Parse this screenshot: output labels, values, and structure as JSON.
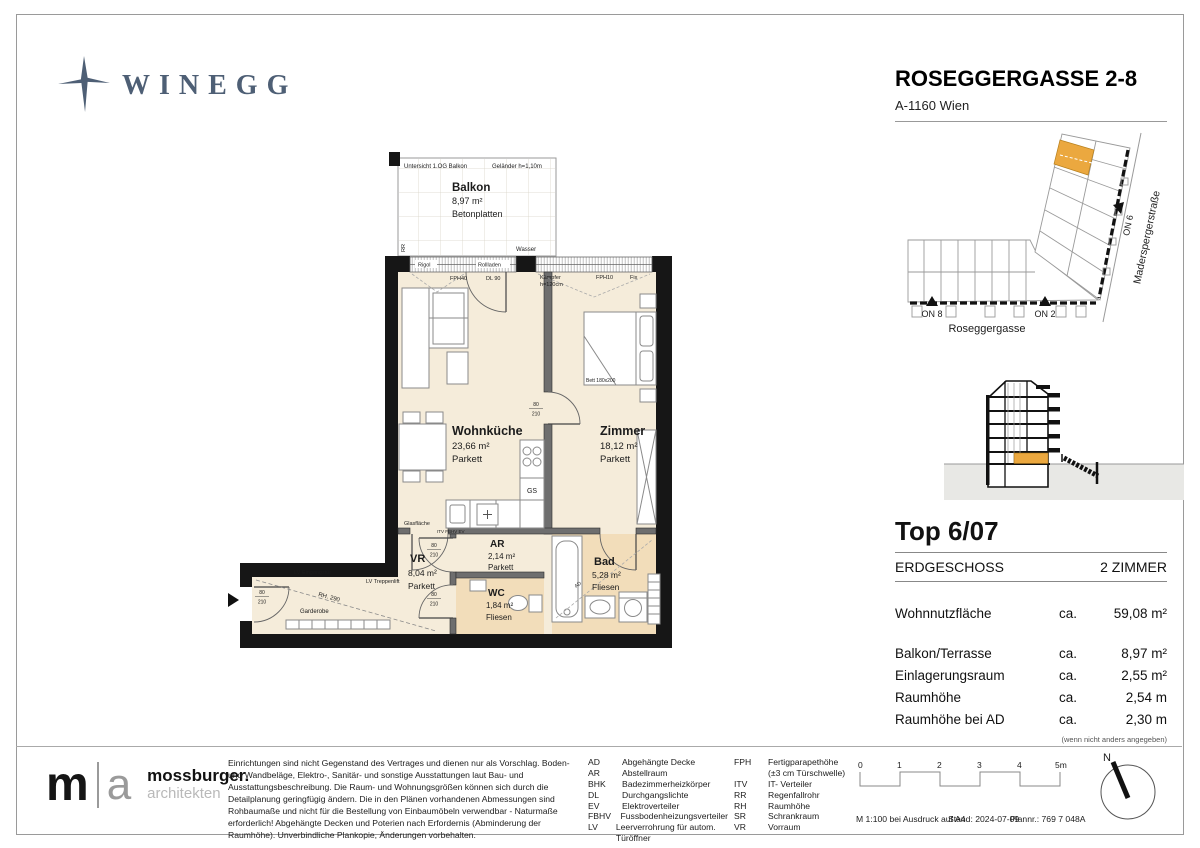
{
  "colors": {
    "brand_blue": "#4E5F75",
    "accent_orange": "#EBA83F",
    "floor_parkett": "#F5ECDA",
    "floor_fliesen": "#F2DDBA",
    "wall_black": "#161616",
    "ground_gray": "#E8E8E5"
  },
  "brand": {
    "logo_text": "WINEGG"
  },
  "header": {
    "title": "ROSEGGERGASSE 2-8",
    "subtitle": "A-1160 Wien"
  },
  "site_plan": {
    "street_bottom": "Roseggergasse",
    "street_right": "Maderspergerstraße",
    "on8": "ON 8",
    "on2": "ON 2",
    "on6": "ON 6"
  },
  "unit": {
    "top": "Top 6/07",
    "floor": "ERDGESCHOSS",
    "rooms": "2 ZIMMER",
    "metrics": [
      {
        "label": "Wohnnutzfläche",
        "ca": "ca.",
        "value": "59,08 m²"
      },
      {
        "label": "Balkon/Terrasse",
        "ca": "ca.",
        "value": "8,97 m²"
      },
      {
        "label": "Einlagerungsraum",
        "ca": "ca.",
        "value": "2,55 m²"
      },
      {
        "label": "Raumhöhe",
        "ca": "ca.",
        "value": "2,54 m"
      },
      {
        "label": "Raumhöhe bei AD",
        "ca": "ca.",
        "value": "2,30 m"
      }
    ],
    "note": "(wenn nicht anders angegeben)"
  },
  "plan": {
    "rooms": {
      "balkon": {
        "name": "Balkon",
        "area": "8,97 m²",
        "floor": "Betonplatten"
      },
      "wohnkueche": {
        "name": "Wohnküche",
        "area": "23,66 m²",
        "floor": "Parkett"
      },
      "zimmer": {
        "name": "Zimmer",
        "area": "18,12 m²",
        "floor": "Parkett"
      },
      "ar": {
        "name": "AR",
        "area": "2,14 m²",
        "floor": "Parkett"
      },
      "vr": {
        "name": "VR",
        "area": "8,04 m²",
        "floor": "Parkett"
      },
      "wc": {
        "name": "WC",
        "area": "1,84 m²",
        "floor": "Fliesen"
      },
      "bad": {
        "name": "Bad",
        "area": "5,28 m²",
        "floor": "Fliesen"
      }
    },
    "annotations": {
      "untersicht": "Untersicht 1.OG Balkon",
      "gelaender": "Geländer h=1,10m",
      "rigol": "Rigol",
      "rollladen": "Rollladen",
      "fph40": "FPH40",
      "dl90": "DL 90",
      "kaempfer": "Kämpfer",
      "kaempfer2": "h=120cm",
      "fph10": "FPH10",
      "fix": "Fix",
      "wasser": "Wasser",
      "rr": "RR",
      "gs": "GS",
      "ev_row": "ITV  FBHV  EV",
      "glas": "Glasfläche",
      "bett": "Bett 180x200",
      "lv_eingang": "LV Eingangstür",
      "lv_treppe": "LV Treppenlift",
      "garderobe": "Garderobe",
      "rh290": "RH. 290",
      "ad": "AD",
      "marker": "6/07",
      "dim_top": "80",
      "dim_bottom": "210"
    }
  },
  "footer": {
    "architect": {
      "mark_m": "m",
      "mark_a": "a",
      "name": "mossburger.",
      "subtitle": "architekten"
    },
    "disclaimer": "Einrichtungen sind nicht Gegenstand des Vertrages und dienen nur als Vorschlag. Boden- und Wandbeläge, Elektro-, Sanitär- und sonstige Ausstattungen laut Bau- und Ausstattungsbeschreibung. Die Raum- und Wohnungsgrößen können sich durch die Detailplanung geringfügig ändern. Die in den Plänen vorhandenen Abmessungen sind Rohbaumaße und nicht für die Bestellung von Einbaumöbeln verwendbar - Naturmaße erforderlich! Abgehängte Decken und Poterien nach Erfordernis (Abminderung der Raumhöhe). Unverbindliche Plankopie, Änderungen vorbehalten.",
    "legend_left": [
      {
        "abbr": "AD",
        "term": "Abgehängte Decke"
      },
      {
        "abbr": "AR",
        "term": "Abstellraum"
      },
      {
        "abbr": "BHK",
        "term": "Badezimmerheizkörper"
      },
      {
        "abbr": "DL",
        "term": "Durchgangslichte"
      },
      {
        "abbr": "EV",
        "term": "Elektroverteiler"
      },
      {
        "abbr": "FBHV",
        "term": "Fussbodenheizungsverteiler"
      },
      {
        "abbr": "LV",
        "term": "Leerverrohrung für autom. Türöffner"
      }
    ],
    "legend_right": [
      {
        "abbr": "FPH",
        "term": "Fertigparapethöhe"
      },
      {
        "abbr": "",
        "term": "(±3 cm Türschwelle)"
      },
      {
        "abbr": "ITV",
        "term": "IT- Verteiler"
      },
      {
        "abbr": "RR",
        "term": "Regenfallrohr"
      },
      {
        "abbr": "RH",
        "term": "Raumhöhe"
      },
      {
        "abbr": "SR",
        "term": "Schrankraum"
      },
      {
        "abbr": "VR",
        "term": "Vorraum"
      }
    ],
    "scale_ticks": [
      "0",
      "1",
      "2",
      "3",
      "4",
      "5m"
    ],
    "meta": {
      "scale": "M 1:100 bei Ausdruck auf A4",
      "date": "Stand: 2024-07-09",
      "plan_no": "Plannr.: 769 7 048A"
    },
    "north": "N"
  }
}
